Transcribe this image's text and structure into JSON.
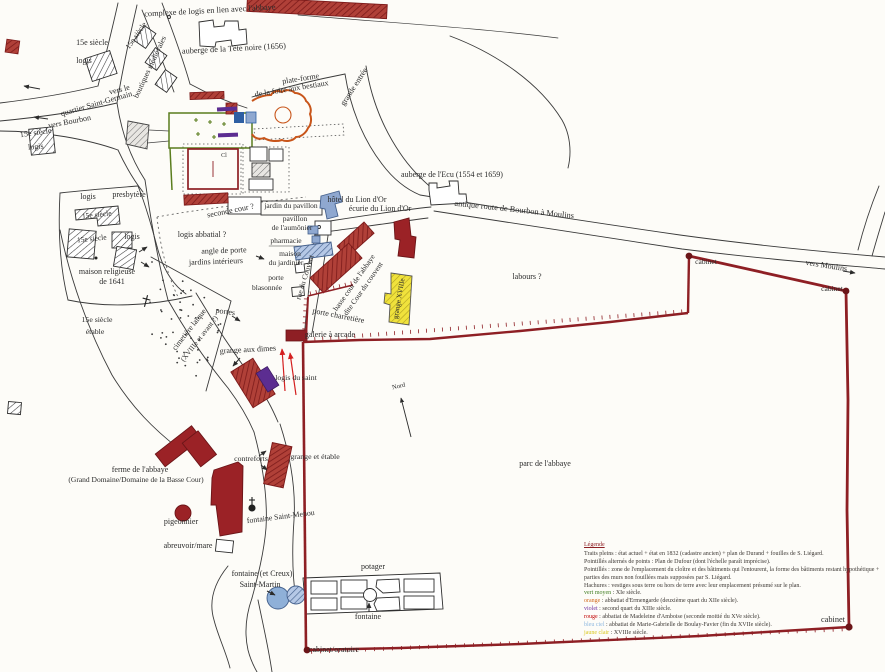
{
  "map": {
    "title": "plan du bourg et de l'abbaye",
    "palette": {
      "wall_dark_red": "#8e1f24",
      "building_red": "#9b2226",
      "hatch_red_line": "#7c1a1a",
      "blue_light": "#8fa8d0",
      "blue_dark": "#2e5fa3",
      "yellow": "#efe23b",
      "purple": "#5c2d91",
      "orange": "#c8551a",
      "green": "#5a7d1e",
      "ink": "#2b2b2b",
      "red_text": "#cc1111"
    },
    "labels": [
      {
        "t": "complexe de logis en lien avec l'abbaye",
        "x": 210,
        "y": 13,
        "r": -3,
        "s": 8.3
      },
      {
        "t": "auberge de la Tête noire (1656)",
        "x": 234,
        "y": 51,
        "r": -3,
        "s": 8.3
      },
      {
        "t": "15e siècle",
        "x": 138,
        "y": 37,
        "r": -55,
        "s": 7.8
      },
      {
        "t": "boutiques médiévales",
        "x": 152,
        "y": 68,
        "r": -65,
        "s": 7.8
      },
      {
        "t": "15e siècle",
        "x": 92,
        "y": 45,
        "s": 8
      },
      {
        "t": "logis",
        "x": 84,
        "y": 63,
        "s": 8
      },
      {
        "t": "vers le",
        "x": 120,
        "y": 92,
        "r": -14,
        "s": 8
      },
      {
        "t": "quartier Saint-Germain",
        "x": 97,
        "y": 106,
        "r": -16,
        "s": 8
      },
      {
        "t": "vers Bourbon",
        "x": 70,
        "y": 124,
        "r": -11,
        "s": 8
      },
      {
        "t": "15e siècle",
        "x": 36,
        "y": 135,
        "r": -8,
        "s": 8
      },
      {
        "t": "logis",
        "x": 36,
        "y": 149,
        "r": -5,
        "s": 8
      },
      {
        "t": "plate-forme",
        "x": 301,
        "y": 81,
        "r": -9,
        "s": 8
      },
      {
        "t": "de la foire aux bestiaux",
        "x": 292,
        "y": 91,
        "r": -9,
        "s": 8
      },
      {
        "t": "grande entrée",
        "x": 356,
        "y": 88,
        "r": -57,
        "s": 8
      },
      {
        "t": "auberge de l'Ecu (1554 et 1659)",
        "x": 452,
        "y": 177,
        "s": 8
      },
      {
        "t": "antique route de Bourbon à Moulins",
        "x": 514,
        "y": 212,
        "r": 6,
        "s": 8.3
      },
      {
        "t": "labours ?",
        "x": 527,
        "y": 279,
        "s": 8
      },
      {
        "t": "vers Moulins",
        "x": 826,
        "y": 268,
        "r": 9,
        "s": 8
      },
      {
        "t": "cabinet",
        "x": 706,
        "y": 264,
        "s": 7.5
      },
      {
        "t": "cabinet",
        "x": 832,
        "y": 291,
        "s": 7.5
      },
      {
        "t": "cabinet",
        "x": 833,
        "y": 622,
        "s": 8.3
      },
      {
        "t": "cabinet/oratoire",
        "x": 334,
        "y": 652,
        "s": 8
      },
      {
        "t": "logis",
        "x": 88,
        "y": 199,
        "s": 8
      },
      {
        "t": "presbytère",
        "x": 129,
        "y": 197,
        "s": 8
      },
      {
        "t": "15e siècle",
        "x": 97,
        "y": 217,
        "r": -6,
        "s": 7.5
      },
      {
        "t": "15e siècle",
        "x": 92,
        "y": 241,
        "r": -6,
        "s": 7.5
      },
      {
        "t": "logis",
        "x": 132,
        "y": 239,
        "s": 8
      },
      {
        "t": "maison religieuse",
        "x": 107,
        "y": 274,
        "s": 8
      },
      {
        "t": "de 1641",
        "x": 112,
        "y": 284,
        "s": 8
      },
      {
        "t": "seconde cour ?",
        "x": 231,
        "y": 213,
        "r": -11,
        "s": 8
      },
      {
        "t": "logis abbatial ?",
        "x": 202,
        "y": 237,
        "s": 8
      },
      {
        "t": "angle de porte",
        "x": 224,
        "y": 253,
        "r": -2,
        "s": 8
      },
      {
        "t": "jardins intérieurs",
        "x": 216,
        "y": 264,
        "r": -2,
        "s": 8
      },
      {
        "t": "jardin du pavillon",
        "x": 291,
        "y": 208,
        "s": 7.5
      },
      {
        "t": "pavillon",
        "x": 295,
        "y": 221,
        "s": 7.5
      },
      {
        "t": "de l'aumônier",
        "x": 292,
        "y": 230,
        "s": 7.5
      },
      {
        "t": "pharmacie",
        "x": 286,
        "y": 243,
        "s": 7.5
      },
      {
        "t": "maison",
        "x": 290,
        "y": 256,
        "s": 7.5
      },
      {
        "t": "du jardinier",
        "x": 286,
        "y": 265,
        "s": 7.5
      },
      {
        "t": "porte",
        "x": 276,
        "y": 280,
        "s": 7.5
      },
      {
        "t": "blasonnée",
        "x": 267,
        "y": 290,
        "s": 7.5
      },
      {
        "t": "rue du Couvent",
        "x": 307,
        "y": 278,
        "r": -73,
        "s": 7.5
      },
      {
        "t": "basse cour de l'abbaye",
        "x": 356,
        "y": 284,
        "r": -55,
        "s": 7.5
      },
      {
        "t": "dite Cour du couvent",
        "x": 365,
        "y": 290,
        "r": -55,
        "s": 7.5
      },
      {
        "t": "porte charretière",
        "x": 338,
        "y": 318,
        "r": 11,
        "s": 8
      },
      {
        "t": "grange XVIIIe",
        "x": 401,
        "y": 299,
        "r": -80,
        "s": 7,
        "c": "#7a7a2a"
      },
      {
        "t": "portes",
        "x": 225,
        "y": 314,
        "r": 8,
        "s": 8
      },
      {
        "t": "15e siècle",
        "x": 97,
        "y": 322,
        "s": 7.8
      },
      {
        "t": "étable",
        "x": 95,
        "y": 334,
        "s": 7.8
      },
      {
        "t": "cimetière laïque",
        "x": 191,
        "y": 331,
        "r": -52,
        "s": 7.8
      },
      {
        "t": "(XVIIIe et avant ?)",
        "x": 201,
        "y": 340,
        "r": -52,
        "s": 7.3
      },
      {
        "t": "grange aux dimes",
        "x": 248,
        "y": 352,
        "r": -3,
        "s": 8
      },
      {
        "t": "logis du saint",
        "x": 296,
        "y": 380,
        "s": 7.8,
        "c": "#cc1111"
      },
      {
        "t": "galerie à arcade",
        "x": 330,
        "y": 337,
        "s": 8
      },
      {
        "t": "ferme de l'abbaye",
        "x": 140,
        "y": 472,
        "s": 8
      },
      {
        "t": "(Grand Domaine/Domaine de la Basse Cour)",
        "x": 136,
        "y": 482,
        "s": 7.5
      },
      {
        "t": "contreforts",
        "x": 251,
        "y": 461,
        "s": 7.8
      },
      {
        "t": "grange et étable",
        "x": 315,
        "y": 459,
        "s": 7.8
      },
      {
        "t": "pigeonnier",
        "x": 181,
        "y": 524,
        "s": 8
      },
      {
        "t": "fontaine Saint-Menou",
        "x": 281,
        "y": 519,
        "r": -7,
        "s": 7.8
      },
      {
        "t": "abreuvoir/mare",
        "x": 188,
        "y": 548,
        "s": 8
      },
      {
        "t": "fontaine (et Creux)",
        "x": 262,
        "y": 576,
        "s": 8
      },
      {
        "t": "Saint-Martin",
        "x": 260,
        "y": 587,
        "s": 8
      },
      {
        "t": "potager",
        "x": 373,
        "y": 569,
        "s": 8
      },
      {
        "t": "fontaine",
        "x": 368,
        "y": 619,
        "s": 8
      },
      {
        "t": "parc de l'abbaye",
        "x": 545,
        "y": 466,
        "s": 8
      },
      {
        "t": "Nord",
        "x": 399,
        "y": 388,
        "r": -12,
        "s": 6.5
      },
      {
        "t": "Cl",
        "x": 224,
        "y": 157,
        "s": 6,
        "c": "#7a3a2a"
      },
      {
        "t": "écurie du Lion d'Or",
        "x": 380,
        "y": 211,
        "s": 8
      },
      {
        "t": "hôtel du Lion d'Or",
        "x": 357,
        "y": 202,
        "s": 8
      }
    ],
    "legend": {
      "title": "Légende",
      "entries": [
        {
          "key": "",
          "key_color": "",
          "text": "Traits pleins : état actuel + état en 1832 (cadastre ancien) + plan de Durand + fouilles de S. Liégard."
        },
        {
          "key": "",
          "key_color": "",
          "text": "Pointillés alternés de points : Plan de Dufour (dont l'échelle paraît imprécise)."
        },
        {
          "key": "",
          "key_color": "",
          "text": "Pointillés : zone de l'emplacement du cloître et des bâtiments qui l'entourent, la forme des bâtiments restant hypothétique + parties des murs non fouillées mais supposées par S. Liégard."
        },
        {
          "key": "",
          "key_color": "",
          "text": "Hachures : vestiges sous terre ou hors de terre avec leur emplacement présumé sur le plan."
        },
        {
          "key": "vert moyen",
          "key_color": "#3f7d20",
          "text": " : XIe siècle."
        },
        {
          "key": "orange",
          "key_color": "#d2691e",
          "text": " : abbatiat d'Ermengarde (deuxième quart du XIIe siècle)."
        },
        {
          "key": "violet",
          "key_color": "#7030a0",
          "text": " : second quart du XIIIe siècle."
        },
        {
          "key": "rouge",
          "key_color": "#c00000",
          "text": " : abbatiat de Madeleine d'Amboise (seconde moitié du XVe siècle)."
        },
        {
          "key": "bleu ciel",
          "key_color": "#8fb8e0",
          "text": " : abbatiat de Marie-Gabrielle de Boulay-Favier (fin du XVIIe siècle)."
        },
        {
          "key": "jaune clair",
          "key_color": "#d9c821",
          "text": " : XVIIIe siècle."
        }
      ]
    }
  }
}
